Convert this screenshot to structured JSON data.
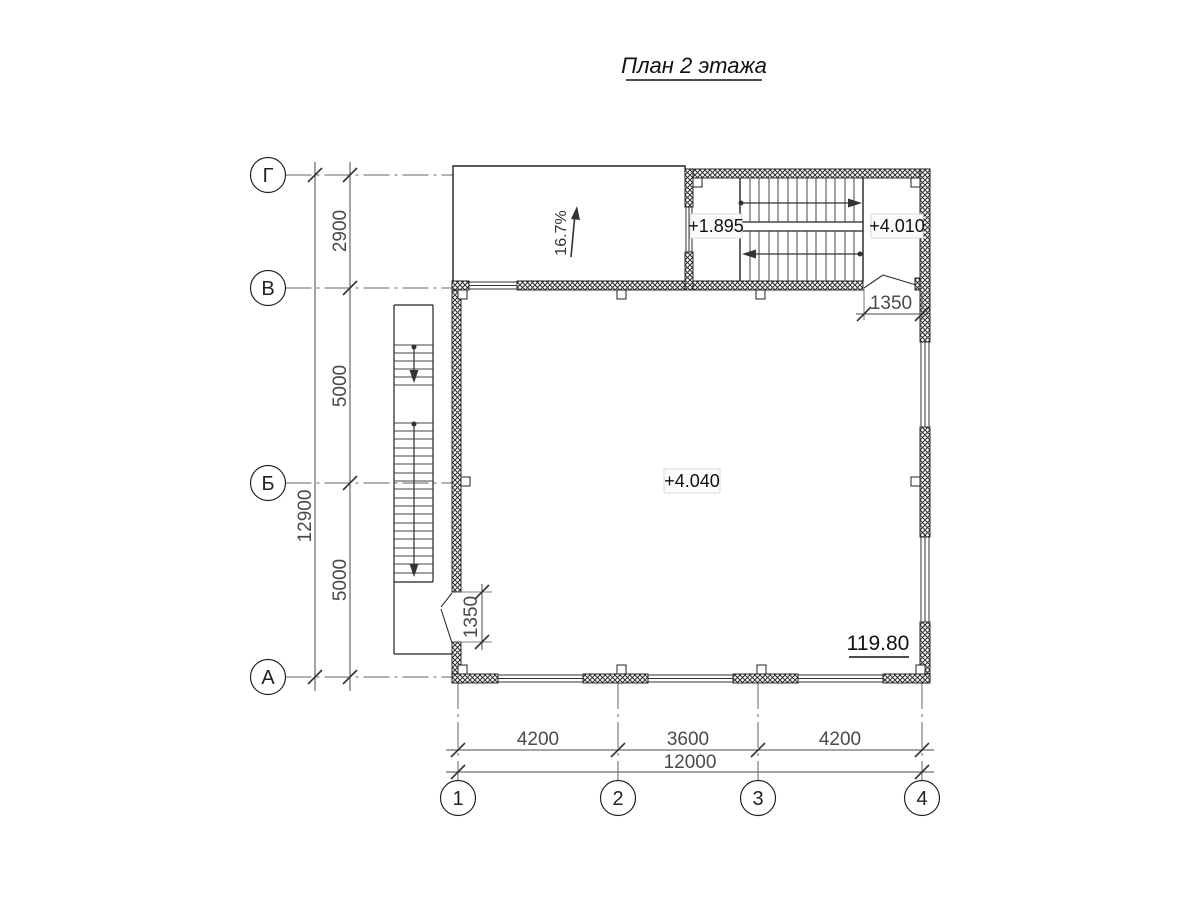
{
  "title": "План 2 этажа",
  "axes": {
    "rows": [
      {
        "label": "Г"
      },
      {
        "label": "В"
      },
      {
        "label": "Б"
      },
      {
        "label": "А"
      }
    ],
    "cols": [
      {
        "label": "1"
      },
      {
        "label": "2"
      },
      {
        "label": "3"
      },
      {
        "label": "4"
      }
    ]
  },
  "dimensions": {
    "left": {
      "segments": [
        "2900",
        "5000",
        "5000"
      ],
      "total": "12900"
    },
    "bottom": {
      "segments": [
        "4200",
        "3600",
        "4200"
      ],
      "total": "12000"
    },
    "left_door_width": "1350",
    "stair_door_width": "1350"
  },
  "labels": {
    "ramp_slope": "16.7%",
    "stair_landing_elevation": "+1.895",
    "stair_top_elevation": "+4.010",
    "floor_elevation": "+4.040",
    "datum": "119.80"
  },
  "colors": {
    "line": "#222222",
    "dimension": "#4a4a4a",
    "hatch": "#2e2e2e",
    "label_box_bg": "#fbfbfb",
    "label_box_border": "#d8d8d8"
  }
}
